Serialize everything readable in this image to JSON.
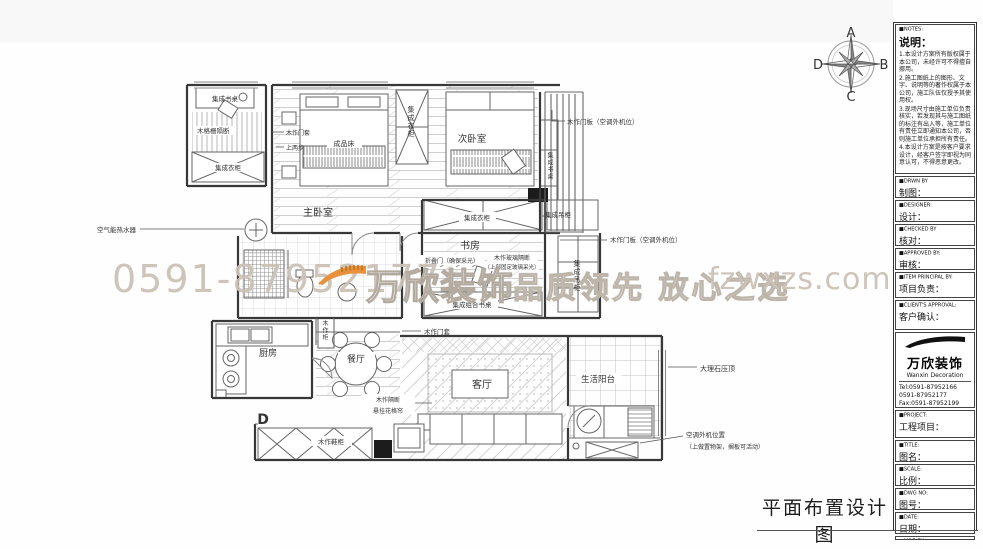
{
  "page": {
    "drawing_title": "平面布置设计图"
  },
  "compass": {
    "n": "A",
    "e": "B",
    "s": "C",
    "w": "D"
  },
  "watermark": {
    "phone": "0591-87952177",
    "brand": "万欣装饰",
    "slogan": "品质领先 放心之选",
    "website": "fzwxzs.com",
    "accent_orange": "#e8923b",
    "text_gray": "#cbc2b5"
  },
  "plan": {
    "labels": [
      {
        "id": "desk-annex",
        "text": "集成书桌"
      },
      {
        "id": "wood-grille",
        "text": "木格栅隔断"
      },
      {
        "id": "wardrobe-annex",
        "text": "集成衣柜"
      },
      {
        "id": "water-heater",
        "text": "空气能热水器"
      },
      {
        "id": "door-casing-1",
        "text": "木作门套"
      },
      {
        "id": "two-steps",
        "text": "上两步"
      },
      {
        "id": "bed",
        "text": "成品床"
      },
      {
        "id": "master-bedroom",
        "text": "主卧室"
      },
      {
        "id": "second-bedroom",
        "text": "次卧室"
      },
      {
        "id": "door-panel-ac-1",
        "text": "木作门板（空调外机位）"
      },
      {
        "id": "wardrobe-study",
        "text": "集成衣柜"
      },
      {
        "id": "hanging-cabinet",
        "text": "集成吊柜"
      },
      {
        "id": "study",
        "text": "书房"
      },
      {
        "id": "folding-door",
        "text": "折叠门（确保采光）"
      },
      {
        "id": "glass-partition",
        "text": "木作玻璃隔断"
      },
      {
        "id": "glass-partition-note",
        "text": "（上部固定玻璃采光）"
      },
      {
        "id": "door-panel-ac-2",
        "text": "木作门板（空调外机位）"
      },
      {
        "id": "combo-desk",
        "text": "集成组合书桌"
      },
      {
        "id": "kitchen",
        "text": "厨房"
      },
      {
        "id": "dining",
        "text": "餐厅"
      },
      {
        "id": "door-casing-2",
        "text": "木作门套"
      },
      {
        "id": "living-room",
        "text": "客厅"
      },
      {
        "id": "balcony",
        "text": "生活阳台"
      },
      {
        "id": "marble-coping",
        "text": "大理石压顶"
      },
      {
        "id": "ac-outdoor",
        "text": "空调外机位置"
      },
      {
        "id": "ac-outdoor-note",
        "text": "（上做置物架，搁板可活动）"
      },
      {
        "id": "wood-partition",
        "text": "木作隔断"
      },
      {
        "id": "hanging-lattice",
        "text": "悬挂花格帘"
      },
      {
        "id": "shoe-cabinet",
        "text": "木作鞋柜"
      },
      {
        "id": "marker-d",
        "text": "D"
      },
      {
        "id": "wardrobe-column-v",
        "text": "集成衣柜"
      },
      {
        "id": "desk-strip-v",
        "text": "集成书桌"
      },
      {
        "id": "hanging-cabinet-v",
        "text": "集成吊柜"
      },
      {
        "id": "wood-cabinet-v",
        "text": "木作柜"
      }
    ]
  },
  "sidebar": {
    "notes": {
      "en": "■NOTES:",
      "title": "说明：",
      "items": [
        "1.本设计方案所有版权属于本公司，未经许可不得擅自挪用。",
        "2.施工图纸上的图形、文字、说明等的著作权属于本公司，施工队伍仅授予其使用权。",
        "3.现场尺寸由施工单位负责核实，若发现其与施工图纸的标注有出入等，施工单位有责任立即通知本公司，否则施工单位承担所有责任。",
        "4.本设计方案是按客户要求设计，经客户签字即视为同意认可，不得恶意更改。"
      ]
    },
    "fields": [
      {
        "en": "■DRWN BY",
        "cn": "制图："
      },
      {
        "en": "■DESIGNER:",
        "cn": "设计："
      },
      {
        "en": "■CHECKED BY",
        "cn": "核对："
      },
      {
        "en": "■APPROVED BY:",
        "cn": "审核："
      },
      {
        "en": "■ITEM PRINCIPAL BY:",
        "cn": "项目负责："
      },
      {
        "en": "■CLIENT'S APPROVAL:",
        "cn": "客户确认："
      },
      {
        "en": "■PROJECT:",
        "cn": "工程项目："
      },
      {
        "en": "■TITLE:",
        "cn": "图名："
      },
      {
        "en": "■SCALE:",
        "cn": "比例："
      },
      {
        "en": "■DWG NO:",
        "cn": "图号："
      },
      {
        "en": "■DATE:",
        "cn": "日期："
      },
      {
        "en": "■MODIFY:",
        "cn": "修改："
      }
    ],
    "logo": {
      "brand": "万欣装饰",
      "sub": "Wanxin Decoration",
      "tel1": "Tel:0591-87952166",
      "tel2": "0591-87952177",
      "fax": "Fax:0591-87952199",
      "web": "Web:WWW.fzwxzs.com"
    }
  }
}
